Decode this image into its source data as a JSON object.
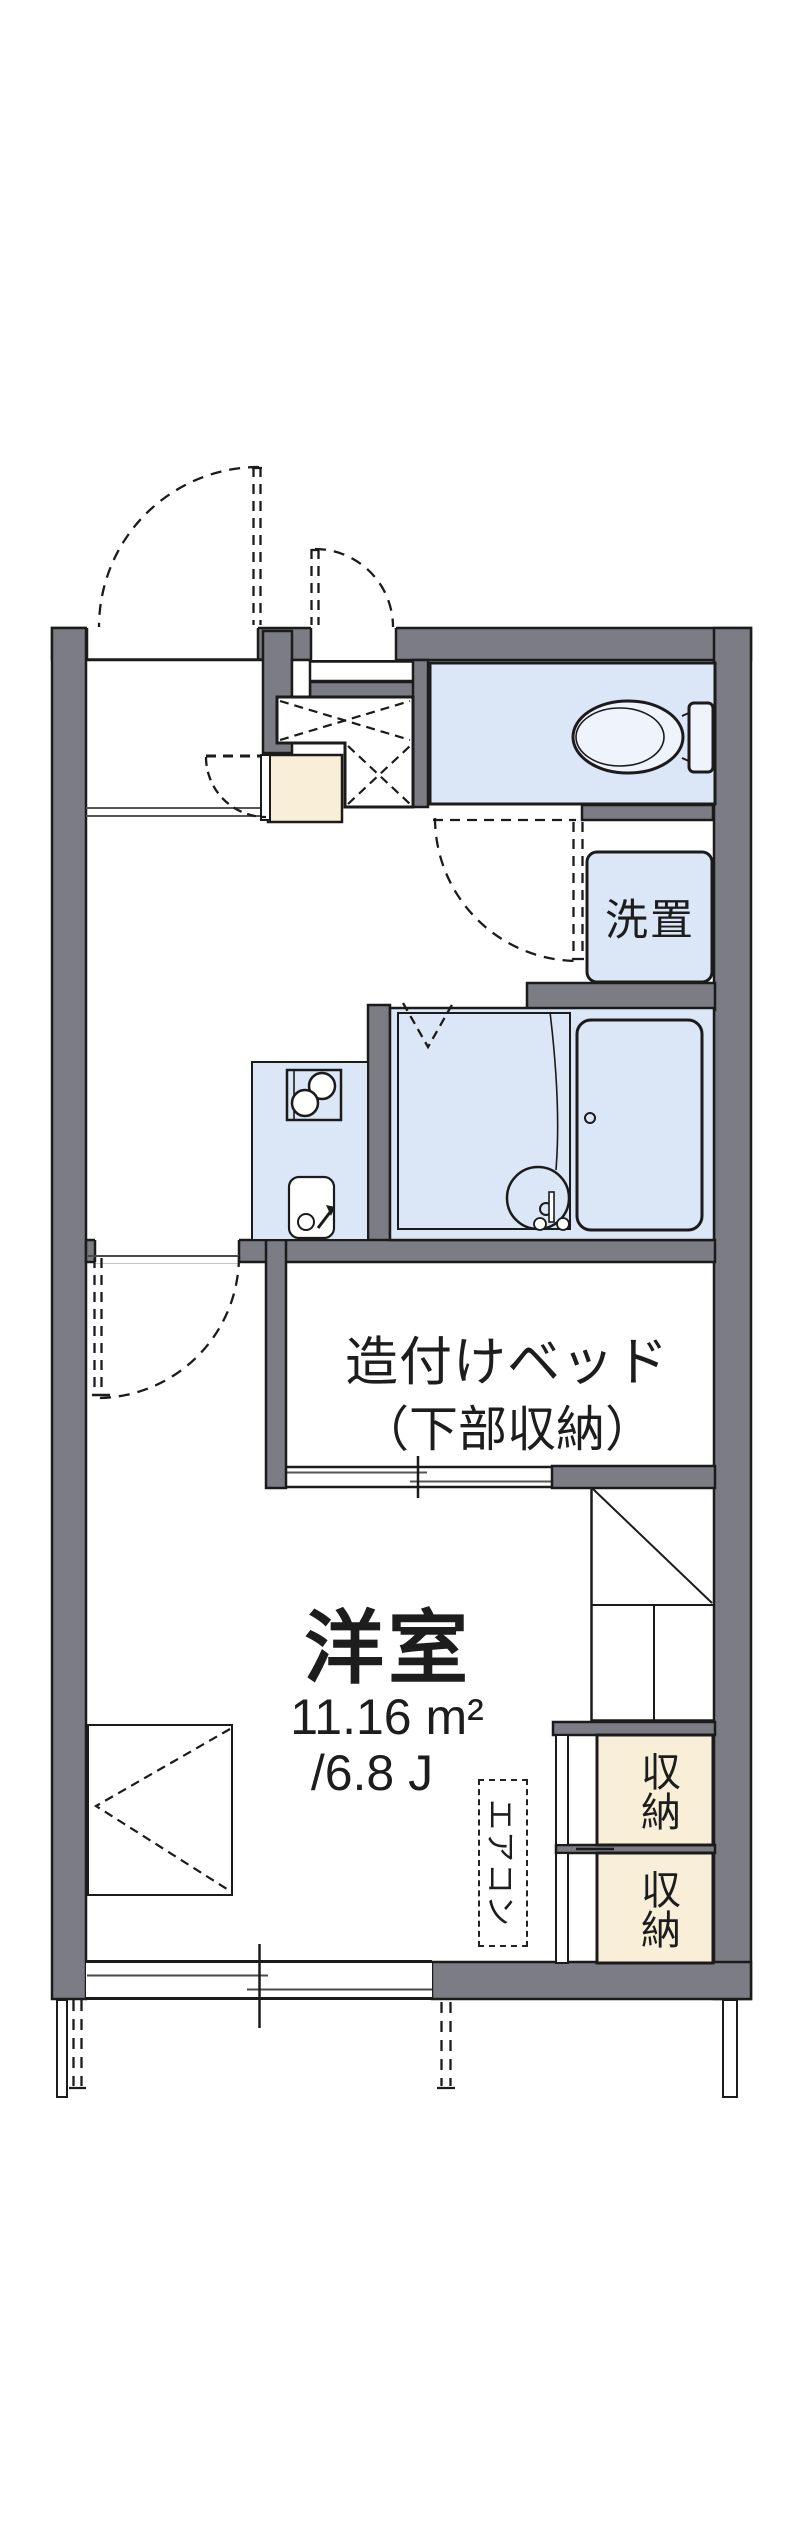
{
  "floorplan": {
    "western_room": {
      "label": "洋室",
      "area_sqm": "11.16 m²",
      "area_tatami": "/6.8 J"
    },
    "built_in_bed": {
      "label": "造付けベッド",
      "sublabel": "（下部収納）"
    },
    "washing_machine_space": {
      "label": "洗置"
    },
    "air_conditioner": {
      "label": "エアコン"
    },
    "storage_upper": {
      "label": "収納"
    },
    "storage_lower": {
      "label": "収納"
    },
    "colors": {
      "wall_gray": "#7c7c84",
      "room_blue": "#dbe6f7",
      "storage_beige": "#f9efd9",
      "line_black": "#1b1b1b"
    },
    "icons": {
      "toilet": "toilet-icon",
      "bathtub": "bathtub-icon",
      "bath_bowl": "bath-faucet-icon",
      "kitchen_sink": "kitchen-sink-icon",
      "stove": "stove-icon"
    }
  }
}
